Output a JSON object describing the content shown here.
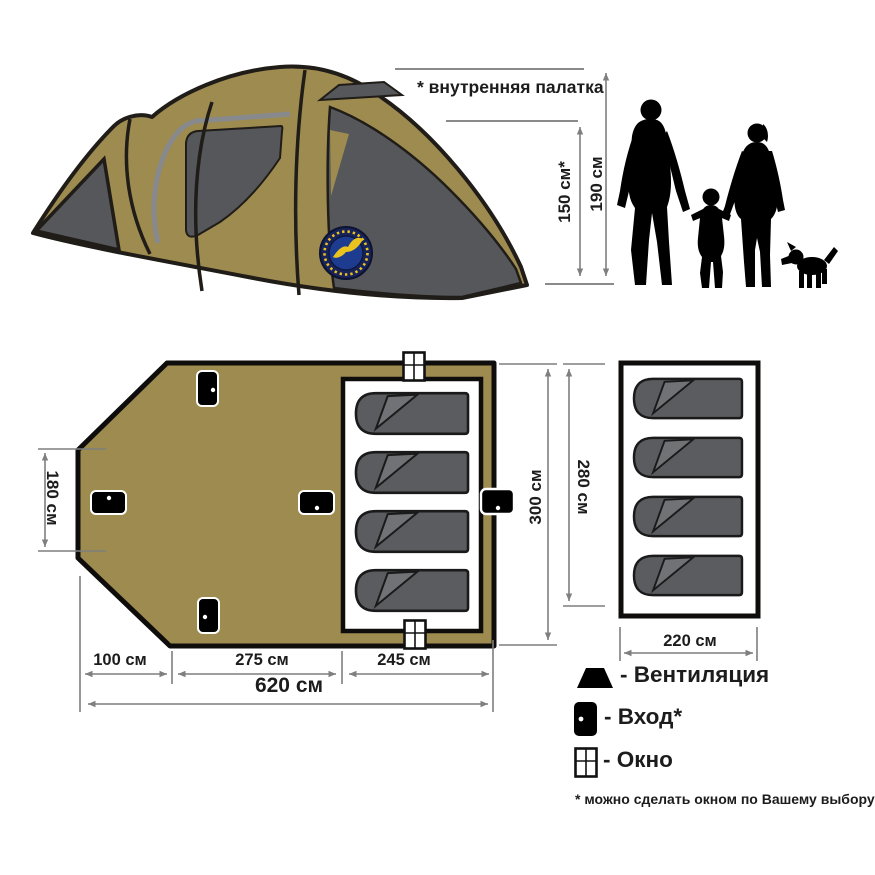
{
  "annotations": {
    "inner_tent_note": "* внутренняя палатка",
    "inner_height_label": "150 см*",
    "outer_height_label": "190 см"
  },
  "main_plan": {
    "left_side_label": "180 см",
    "depth_label": "300 см",
    "segment_vestibule_label": "100 см",
    "segment_middle_label": "275 см",
    "segment_inner_label": "245 см",
    "total_length_label": "620 см"
  },
  "inner_plan": {
    "depth_label": "280 см",
    "width_label": "220 см"
  },
  "legend": {
    "ventilation_label": "- Вентиляция",
    "entrance_label": "- Вход*",
    "window_label": "- Окно",
    "footnote": "* можно сделать окном по Вашему выбору"
  },
  "icons": {
    "ventilation": "vent-icon",
    "entrance": "door-icon",
    "window": "window-icon",
    "sleeping_place": "sleeping-bag-icon",
    "brand": "brand-logo"
  },
  "colors": {
    "tent_khaki": "#9e8b50",
    "panel_gray": "#55575a",
    "outline_black": "#201c18",
    "dimension_gray": "#7f7f7f",
    "logo_navy": "#18235a",
    "logo_blue": "#1e3c8f",
    "logo_yellow": "#eac31f"
  }
}
